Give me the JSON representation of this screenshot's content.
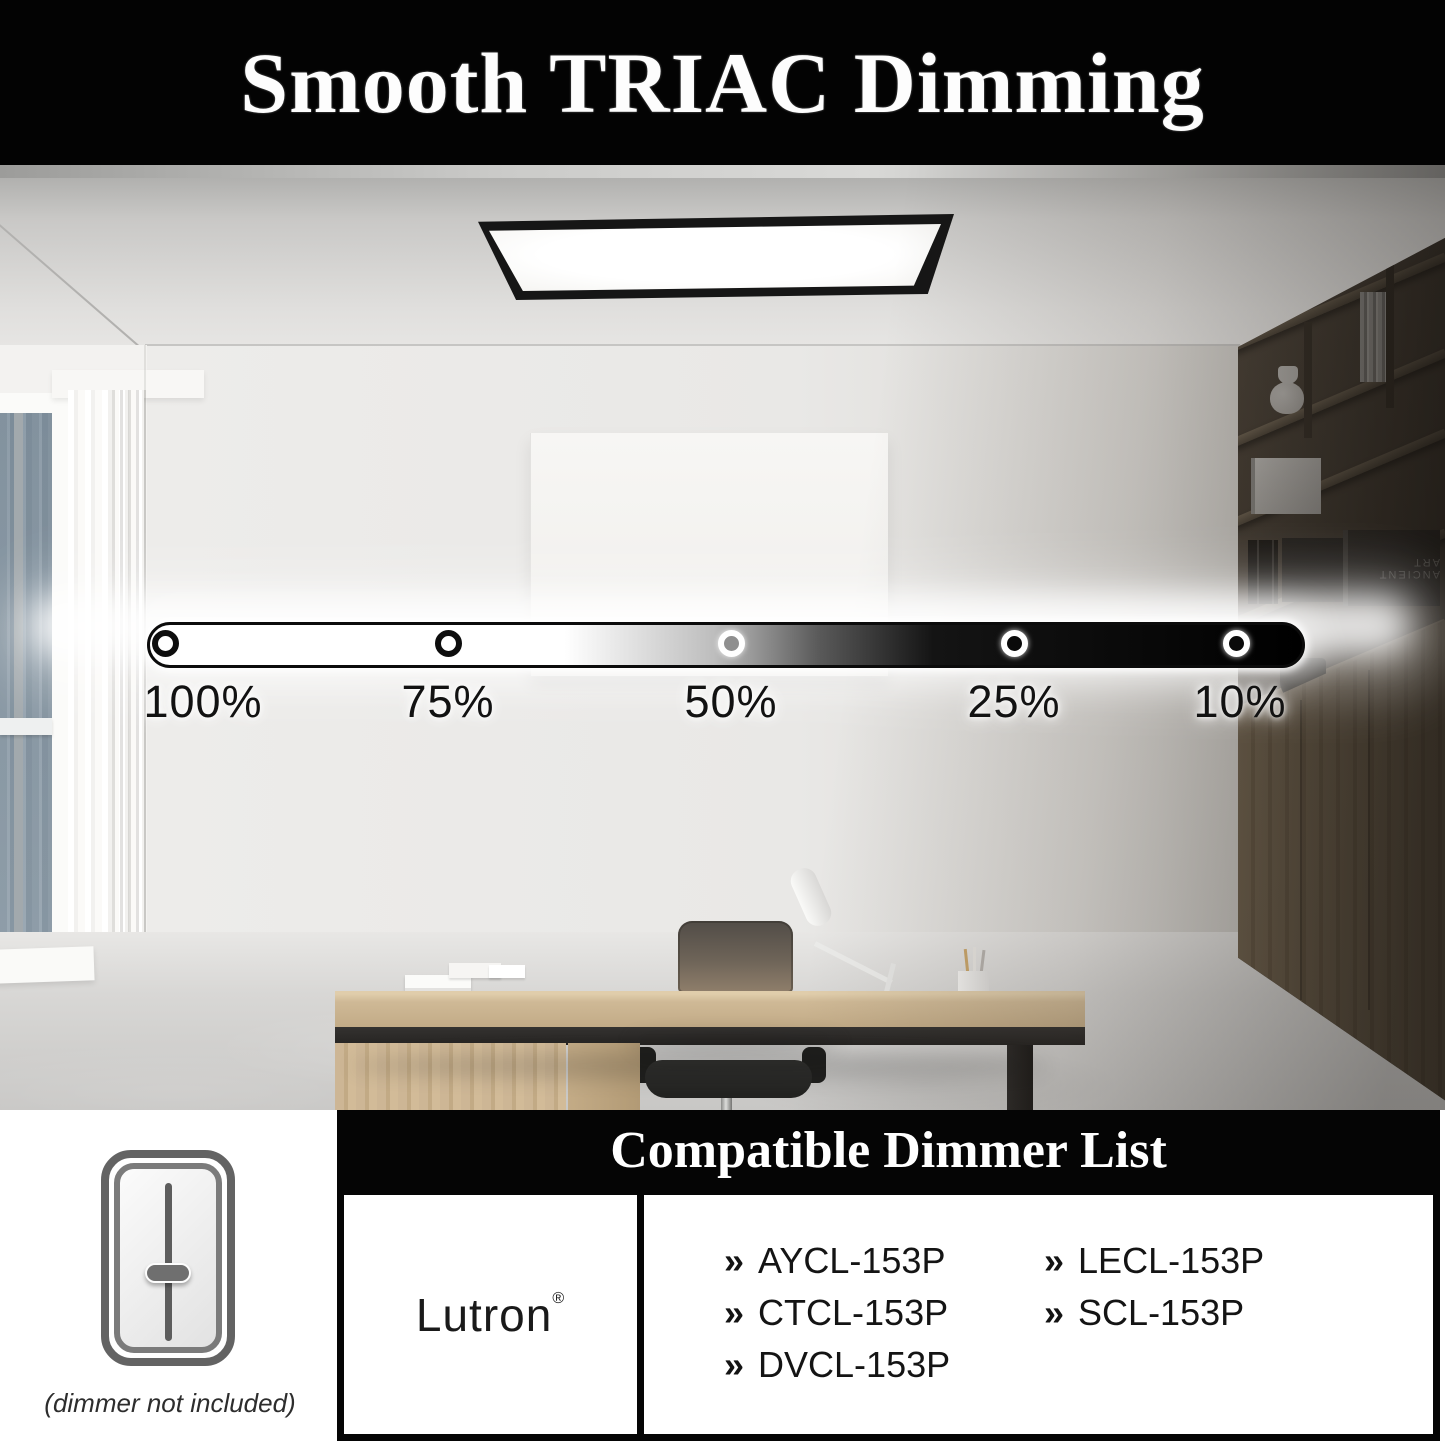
{
  "banner": {
    "title": "Smooth TRIAC Dimming"
  },
  "dimmer_scale": {
    "levels": [
      {
        "label": "100%",
        "state": "on"
      },
      {
        "label": "75%",
        "state": "on"
      },
      {
        "label": "50%",
        "state": "mid"
      },
      {
        "label": "25%",
        "state": "off"
      },
      {
        "label": "10%",
        "state": "off"
      }
    ]
  },
  "scene": {
    "shelf_book_label": "ANCIENT ART"
  },
  "panel": {
    "header": "Compatible Dimmer List",
    "brand": "Lutron",
    "brand_mark": "®",
    "bullet": "»",
    "models_col1": [
      "AYCL-153P",
      "CTCL-153P",
      "DVCL-153P"
    ],
    "models_col2": [
      "LECL-153P",
      "SCL-153P"
    ],
    "note": "(dimmer not included)"
  },
  "colors": {
    "banner_bg": "#030303",
    "banner_text": "#fdfdfd",
    "bar_bright": "#ffffff",
    "bar_dark": "#000000",
    "panel_bg": "#050505",
    "model_text": "#141414"
  }
}
